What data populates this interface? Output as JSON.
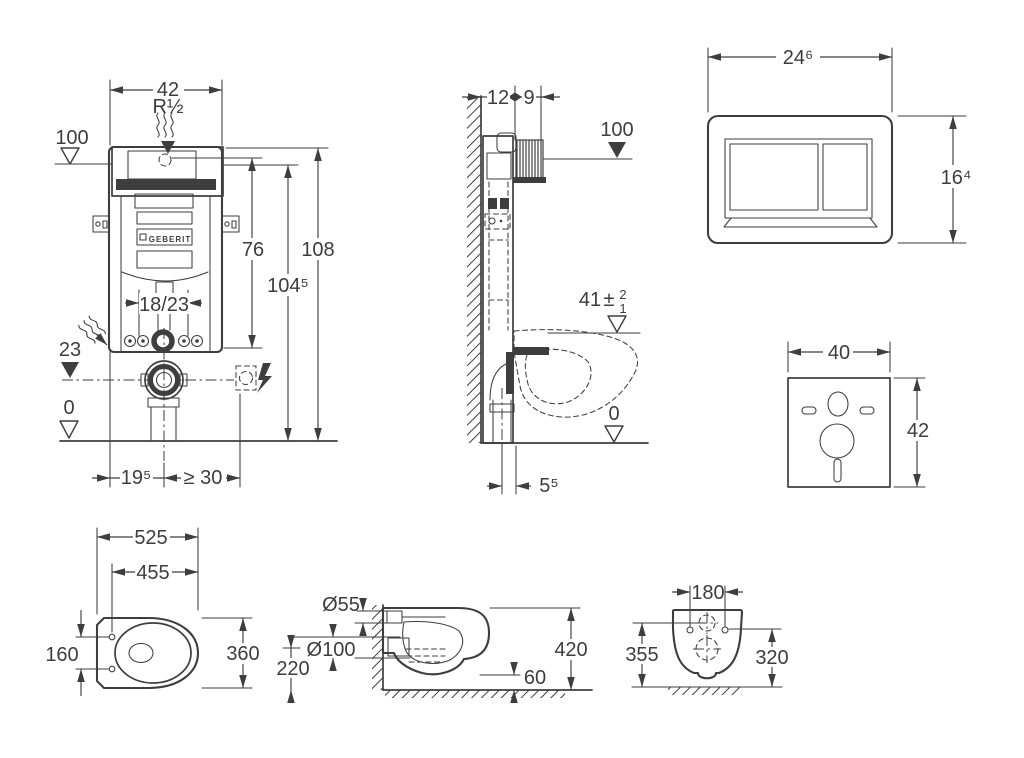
{
  "views": {
    "front": {
      "width": "42",
      "inlet": "R½",
      "level_top": "100",
      "h76": "76",
      "h104": "104⁵",
      "h108": "108",
      "rail": "18/23",
      "level_outlet": "23",
      "level_floor": "0",
      "off_left": "19⁵",
      "off_right": "≥ 30",
      "brand": "GEBERIT"
    },
    "side": {
      "d12": "12",
      "d9": "9",
      "level_top": "100",
      "seat": "41",
      "pm": "±",
      "tol_up": "2",
      "tol_dn": "1",
      "level_floor": "0",
      "offset": "5⁵"
    },
    "plate": {
      "width": "24⁶",
      "height": "16⁴"
    },
    "mat": {
      "width": "40",
      "height": "42"
    },
    "pan_top": {
      "length": "525",
      "depth": "455",
      "holes": "160",
      "width": "360"
    },
    "pan_side": {
      "inlet": "Ø55",
      "outlet": "Ø100",
      "outlet_h": "220",
      "height": "420",
      "clearance": "60"
    },
    "pan_rear": {
      "holes": "180",
      "h355": "355",
      "h320": "320"
    }
  }
}
